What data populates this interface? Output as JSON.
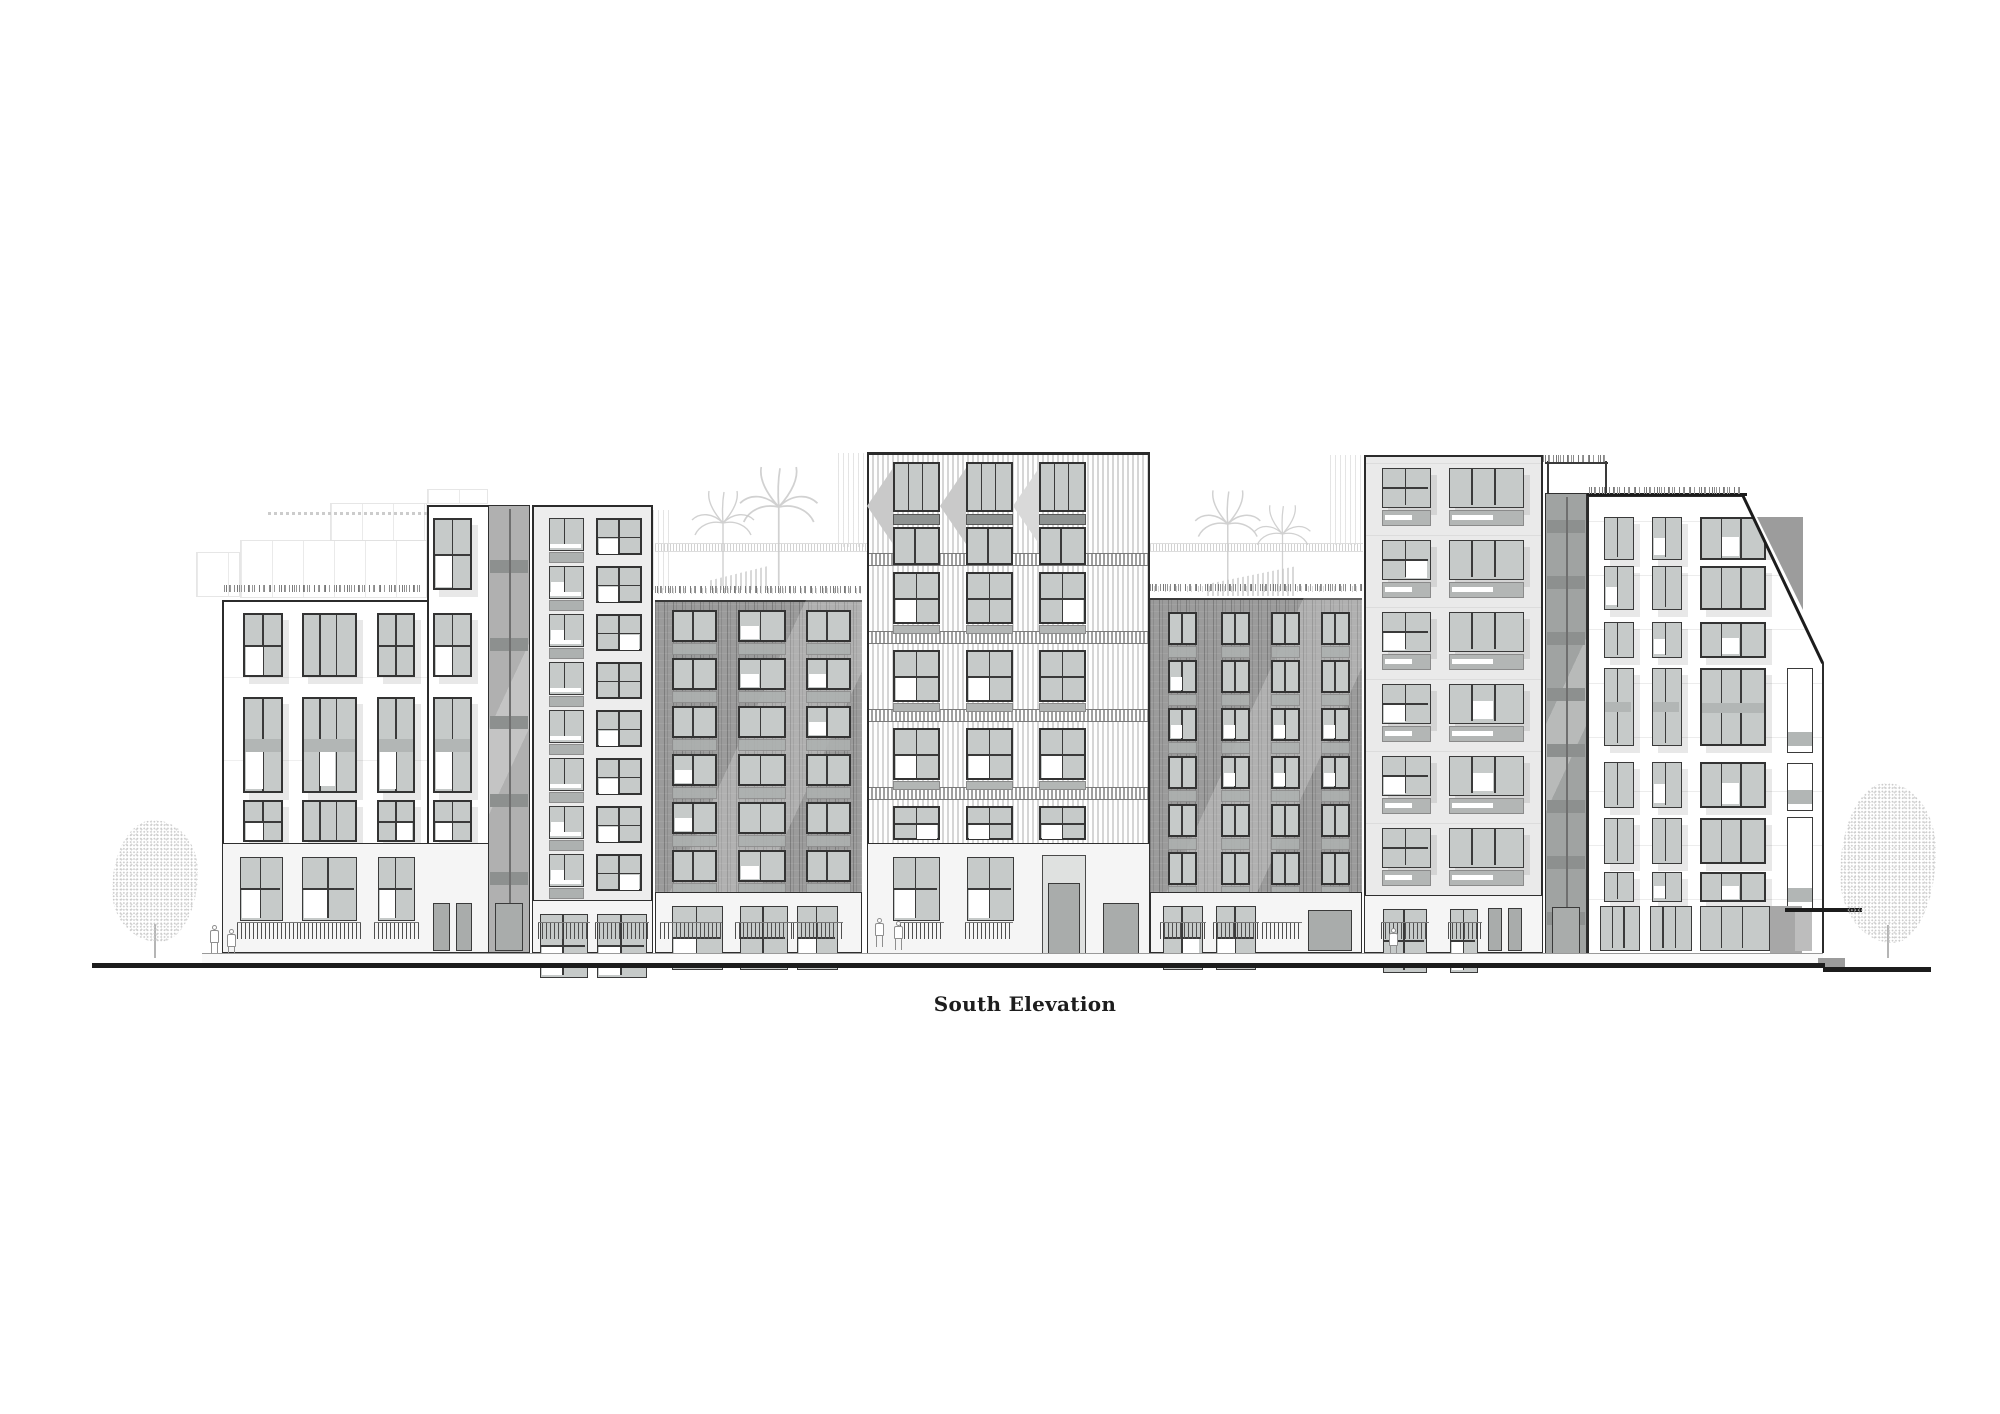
{
  "title": {
    "text": "South Elevation"
  },
  "palette": {
    "line": "#2b2b2b",
    "frame": "#333333",
    "glass_gray": "#c6cac9",
    "glass_white": "#ffffff",
    "spandrel": "#adb1b0",
    "dark_band": "#8f9392",
    "brick": "#9b9b9b",
    "tower_stripe": "#d6d6d6",
    "base_wall": "#f5f5f5",
    "ghost": "#d6d6d6",
    "tree": "#c2c2c2",
    "ground": "#1c1c1c"
  },
  "drawing": {
    "page": {
      "width": 2000,
      "height": 1414
    },
    "ground": {
      "segments": [
        {
          "x": 92,
          "y": 963,
          "w": 1733,
          "h": 5
        },
        {
          "x": 1823,
          "y": 967,
          "w": 108,
          "h": 5
        }
      ],
      "step": {
        "x": 1818,
        "y": 958,
        "w": 27,
        "h": 9
      },
      "sidewalk": {
        "x": 202,
        "y": 953,
        "w": 1621,
        "h": 10
      }
    },
    "buildings": [
      {
        "id": "building-1",
        "kind": "b1",
        "x": 222,
        "right": 427,
        "top": 600,
        "bottom": 843,
        "tall": {
          "x": 427,
          "right": 490,
          "top": 505
        },
        "cols": [
          {
            "x": 243,
            "w": 40
          },
          {
            "x": 302,
            "w": 55
          },
          {
            "x": 377,
            "w": 38
          },
          {
            "x": 433,
            "w": 39
          }
        ],
        "rows": [
          {
            "y": 613,
            "h": 64
          },
          {
            "y": 697,
            "h": 96
          },
          {
            "y": 800,
            "h": 42
          }
        ],
        "tallRow": {
          "y": 518,
          "h": 72
        },
        "base": {
          "x": 222,
          "right": 490,
          "top": 843,
          "bottom": 953,
          "openings": [
            {
              "x": 240,
              "w": 43,
              "t": "win"
            },
            {
              "x": 302,
              "w": 55,
              "t": "win"
            },
            {
              "x": 378,
              "w": 37,
              "t": "win"
            },
            {
              "x": 433,
              "w": 39,
              "t": "door2"
            }
          ],
          "fences": [
            {
              "x": 237,
              "w": 64
            },
            {
              "x": 300,
              "w": 61
            },
            {
              "x": 374,
              "w": 45
            }
          ]
        },
        "veg": {
          "x": 224,
          "w": 200,
          "y": 591
        }
      },
      {
        "id": "building-2",
        "kind": "b2",
        "x": 532,
        "right": 653,
        "top": 505,
        "bottom": 900,
        "cols": [
          {
            "x": 549,
            "w": 35
          },
          {
            "x": 596,
            "w": 46
          }
        ],
        "rowStart": 518,
        "pitch": 48,
        "rowCount": 8,
        "winH": 33,
        "base": {
          "x": 532,
          "right": 653,
          "top": 900,
          "bottom": 953,
          "openings": [
            {
              "x": 540,
              "w": 48,
              "t": "win"
            },
            {
              "x": 597,
              "w": 50,
              "t": "win"
            }
          ],
          "fences": [
            {
              "x": 538,
              "w": 52
            },
            {
              "x": 595,
              "w": 54
            }
          ]
        }
      },
      {
        "id": "building-3-brick",
        "kind": "brick",
        "x": 655,
        "right": 862,
        "top": 600,
        "bottom": 892,
        "cols": [
          {
            "x": 672,
            "w": 45
          },
          {
            "x": 738,
            "w": 48
          },
          {
            "x": 806,
            "w": 45
          }
        ],
        "rowStart": 610,
        "pitch": 48,
        "rowCount": 6,
        "winH": 32,
        "base": {
          "x": 655,
          "right": 862,
          "top": 892,
          "bottom": 953,
          "openings": [
            {
              "x": 672,
              "w": 51,
              "t": "win"
            },
            {
              "x": 740,
              "w": 48,
              "t": "win"
            },
            {
              "x": 797,
              "w": 41,
              "t": "win"
            }
          ],
          "fences": [
            {
              "x": 660,
              "w": 62
            },
            {
              "x": 735,
              "w": 58
            },
            {
              "x": 793,
              "w": 50
            }
          ]
        },
        "veg": {
          "x": 655,
          "w": 207,
          "y": 592
        }
      },
      {
        "id": "building-4-tower",
        "kind": "tower",
        "x": 867,
        "right": 1150,
        "top": 452,
        "bottom": 843,
        "cols": [
          {
            "x": 893,
            "w": 47
          },
          {
            "x": 966,
            "w": 47
          },
          {
            "x": 1039,
            "w": 47
          }
        ],
        "topA": {
          "y": 462,
          "h": 50
        },
        "darkBand": {
          "y": 514,
          "h": 11
        },
        "topB": {
          "y": 527,
          "h": 38
        },
        "bands": [
          553,
          631,
          709,
          787
        ],
        "rows": [
          572,
          650,
          728,
          806
        ],
        "winH": 52,
        "base": {
          "x": 867,
          "right": 1150,
          "top": 843,
          "bottom": 957,
          "openings": [
            {
              "x": 893,
              "w": 47,
              "t": "win"
            },
            {
              "x": 967,
              "w": 47,
              "t": "win"
            }
          ],
          "portal": {
            "x": 1042,
            "w": 44
          },
          "sideDoor": {
            "x": 1103,
            "w": 36
          },
          "fences": [
            {
              "x": 900,
              "w": 44
            },
            {
              "x": 965,
              "w": 48
            }
          ]
        }
      },
      {
        "id": "building-5-brick",
        "kind": "brick",
        "x": 1150,
        "right": 1362,
        "top": 598,
        "bottom": 892,
        "cols": [
          {
            "x": 1168,
            "w": 29
          },
          {
            "x": 1221,
            "w": 29
          },
          {
            "x": 1271,
            "w": 29
          },
          {
            "x": 1321,
            "w": 29
          }
        ],
        "rowStart": 612,
        "pitch": 48,
        "rowCount": 6,
        "winH": 33,
        "base": {
          "x": 1150,
          "right": 1362,
          "top": 892,
          "bottom": 953,
          "openings": [
            {
              "x": 1163,
              "w": 40,
              "t": "win"
            },
            {
              "x": 1216,
              "w": 40,
              "t": "win"
            },
            {
              "x": 1308,
              "w": 44,
              "t": "door"
            }
          ],
          "fences": [
            {
              "x": 1160,
              "w": 46
            },
            {
              "x": 1213,
              "w": 46
            },
            {
              "x": 1262,
              "w": 40
            }
          ]
        },
        "veg": {
          "x": 1150,
          "w": 212,
          "y": 590
        }
      },
      {
        "id": "building-6",
        "kind": "b6",
        "x": 1364,
        "right": 1543,
        "top": 455,
        "bottom": 895,
        "cols": [
          {
            "x": 1382,
            "w": 49
          },
          {
            "x": 1449,
            "w": 75
          }
        ],
        "rows": [
          468,
          540,
          612,
          684,
          756,
          828
        ],
        "winH": 40,
        "base": {
          "x": 1364,
          "right": 1543,
          "top": 895,
          "bottom": 953,
          "openings": [
            {
              "x": 1383,
              "w": 44,
              "t": "win"
            },
            {
              "x": 1450,
              "w": 28,
              "t": "win"
            }
          ],
          "doors": [
            {
              "x": 1488,
              "w": 14
            },
            {
              "x": 1508,
              "w": 14
            }
          ],
          "fences": [
            {
              "x": 1381,
              "w": 48
            },
            {
              "x": 1448,
              "w": 34
            }
          ]
        }
      },
      {
        "id": "building-7",
        "kind": "b7",
        "x": 1587,
        "right": 1825,
        "top": 495,
        "bottom": 953,
        "slope": {
          "x1": 1743,
          "y1": 495,
          "x2": 1823,
          "y2": 663
        },
        "cols": [
          {
            "x": 1604,
            "w": 30
          },
          {
            "x": 1652,
            "w": 30
          },
          {
            "x": 1700,
            "w": 66
          }
        ],
        "rows": [
          {
            "y": 517,
            "h": 43
          },
          {
            "y": 566,
            "h": 44
          },
          {
            "y": 622,
            "h": 36
          },
          {
            "y": 668,
            "h": 78
          },
          {
            "y": 762,
            "h": 46
          },
          {
            "y": 818,
            "h": 46
          },
          {
            "y": 872,
            "h": 30
          }
        ],
        "col4": {
          "x": 1787,
          "w": 26,
          "wins": [
            {
              "y": 668,
              "h": 85
            },
            {
              "y": 763,
              "h": 48
            },
            {
              "y": 817,
              "h": 92
            }
          ]
        },
        "storefront": [
          {
            "x": 1600,
            "w": 40
          },
          {
            "x": 1650,
            "w": 42
          },
          {
            "x": 1700,
            "w": 70
          }
        ],
        "recess": {
          "x": 1770,
          "w": 32
        },
        "veg": {
          "x": 1589,
          "w": 152,
          "y": 488
        },
        "backTriangle": [
          [
            1757,
            517
          ],
          [
            1803,
            517
          ],
          [
            1803,
            610
          ]
        ]
      }
    ],
    "cores": [
      {
        "id": "stair-core-1",
        "x": 488,
        "w": 42,
        "top": 505,
        "bottom": 953,
        "bandStart": 560,
        "bandPitch": 78,
        "dark": false
      },
      {
        "id": "stair-core-2",
        "x": 1545,
        "w": 42,
        "top": 493,
        "bottom": 957,
        "bandStart": 520,
        "bandPitch": 56,
        "dark": true
      }
    ],
    "pergola": {
      "posts": [
        1547,
        1605
      ],
      "top": 455,
      "bottom": 493,
      "barY": 462,
      "x": 1545,
      "w": 63
    },
    "canopy": {
      "x": 1785,
      "y": 908,
      "w": 77,
      "h": 4,
      "support": {
        "x": 1795,
        "w": 17,
        "top": 912,
        "bottom": 951
      }
    },
    "ghosts": {
      "rects": [
        {
          "x": 240,
          "y": 540,
          "w": 187,
          "h": 58,
          "cls": "ghost-rect"
        },
        {
          "x": 330,
          "y": 503,
          "w": 97,
          "h": 38,
          "cls": "ghost-rect"
        },
        {
          "x": 427,
          "y": 489,
          "w": 61,
          "h": 15,
          "cls": "ghost-rect"
        },
        {
          "x": 196,
          "y": 552,
          "w": 44,
          "h": 45,
          "cls": "ghost-rect"
        },
        {
          "x": 838,
          "y": 453,
          "w": 28,
          "h": 94,
          "cls": "ghost-stripes"
        },
        {
          "x": 1330,
          "y": 455,
          "w": 33,
          "h": 90,
          "cls": "ghost-stripes"
        },
        {
          "x": 653,
          "y": 510,
          "w": 20,
          "h": 80,
          "cls": "ghost-stripes"
        }
      ],
      "rails": [
        {
          "x": 655,
          "y": 543,
          "w": 212
        },
        {
          "x": 1150,
          "y": 543,
          "w": 213
        }
      ],
      "planters": [
        {
          "x": 710,
          "y": 566,
          "w": 58,
          "h": 24
        },
        {
          "x": 1207,
          "y": 566,
          "w": 90,
          "h": 30
        }
      ],
      "scribbles": [
        {
          "x": 268,
          "y": 512,
          "w": 162
        }
      ],
      "vegGhost": [
        {
          "x": 656,
          "y": 588,
          "w": 210
        },
        {
          "x": 1152,
          "y": 586,
          "w": 210
        }
      ],
      "palms": [
        {
          "cx": 723,
          "base": 588,
          "s": 1.0
        },
        {
          "cx": 779,
          "base": 588,
          "s": 1.25
        },
        {
          "cx": 1228,
          "base": 592,
          "s": 1.05
        },
        {
          "cx": 1282,
          "base": 592,
          "s": 0.9
        }
      ]
    },
    "trees": [
      {
        "id": "street-tree-left",
        "cx": 155,
        "top": 820,
        "w": 86,
        "h": 122,
        "trunkBottom": 958
      },
      {
        "id": "street-tree-right",
        "cx": 1888,
        "top": 783,
        "w": 96,
        "h": 160,
        "trunkBottom": 958
      }
    ],
    "people": [
      {
        "x": 209,
        "y": 925
      },
      {
        "x": 226,
        "y": 929
      },
      {
        "x": 874,
        "y": 918
      },
      {
        "x": 893,
        "y": 921
      },
      {
        "x": 1388,
        "y": 928
      }
    ]
  }
}
